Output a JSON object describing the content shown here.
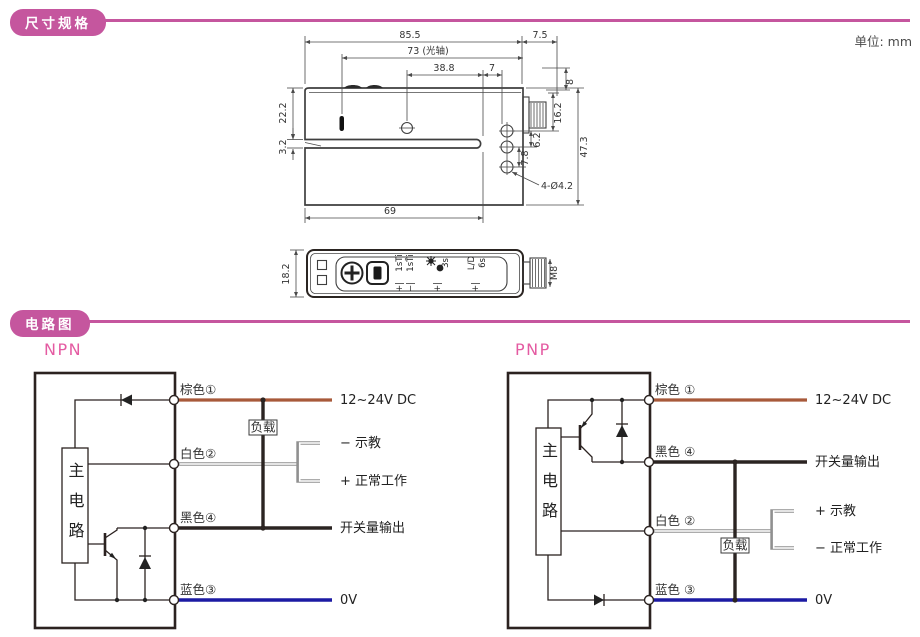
{
  "page": {
    "unit": "单位: mm",
    "accent": "#c5569e"
  },
  "sections": [
    {
      "title": "尺寸规格"
    },
    {
      "title": "电路图"
    }
  ],
  "side_view": {
    "d85_5": "85.5",
    "d73": "73 (光轴)",
    "d38_8": "38.8",
    "d7": "7",
    "d7_5": "7.5",
    "d8": "8",
    "d16_2": "16.2",
    "d6_2": "6.2",
    "d7_8": "7.8",
    "d47_3": "47.3",
    "d22_2": "22.2",
    "d3_2": "3.2",
    "d69": "69",
    "holes": "4-Ø4.2"
  },
  "bottom_view": {
    "d18_2": "18.2",
    "m8": "M8",
    "timer1": "1sTi",
    "timer2": "1sT̄i",
    "mark1": "+|",
    "mark2": "−|",
    "sens_time": "3s",
    "mark3": "+|",
    "ld": "L/D",
    "ld_time": "6s",
    "mark4": "+|"
  },
  "circuits": {
    "npn": {
      "title": "NPN",
      "main": "主电路",
      "load": "负载",
      "wires": {
        "brown": "棕色①",
        "white": "白色②",
        "black": "黑色④",
        "blue": "蓝色③"
      },
      "ext": {
        "power": "12~24V DC",
        "teach": "−  示教",
        "normal": "+  正常工作",
        "output": "开关量输出",
        "gnd": "0V"
      }
    },
    "pnp": {
      "title": "PNP",
      "main": "主电路",
      "load": "负载",
      "wires": {
        "brown": "棕色 ①",
        "black": "黑色 ④",
        "white": "白色 ②",
        "blue": "蓝色 ③"
      },
      "ext": {
        "power": "12~24V DC",
        "output": "开关量输出",
        "teach": "+  示教",
        "normal": "−  正常工作",
        "gnd": "0V"
      }
    }
  },
  "colors": {
    "brown_wire": "#a8593a",
    "blue_wire": "#1c1aa3",
    "black_wire": "#2b2422",
    "white_wire": "#909090"
  }
}
